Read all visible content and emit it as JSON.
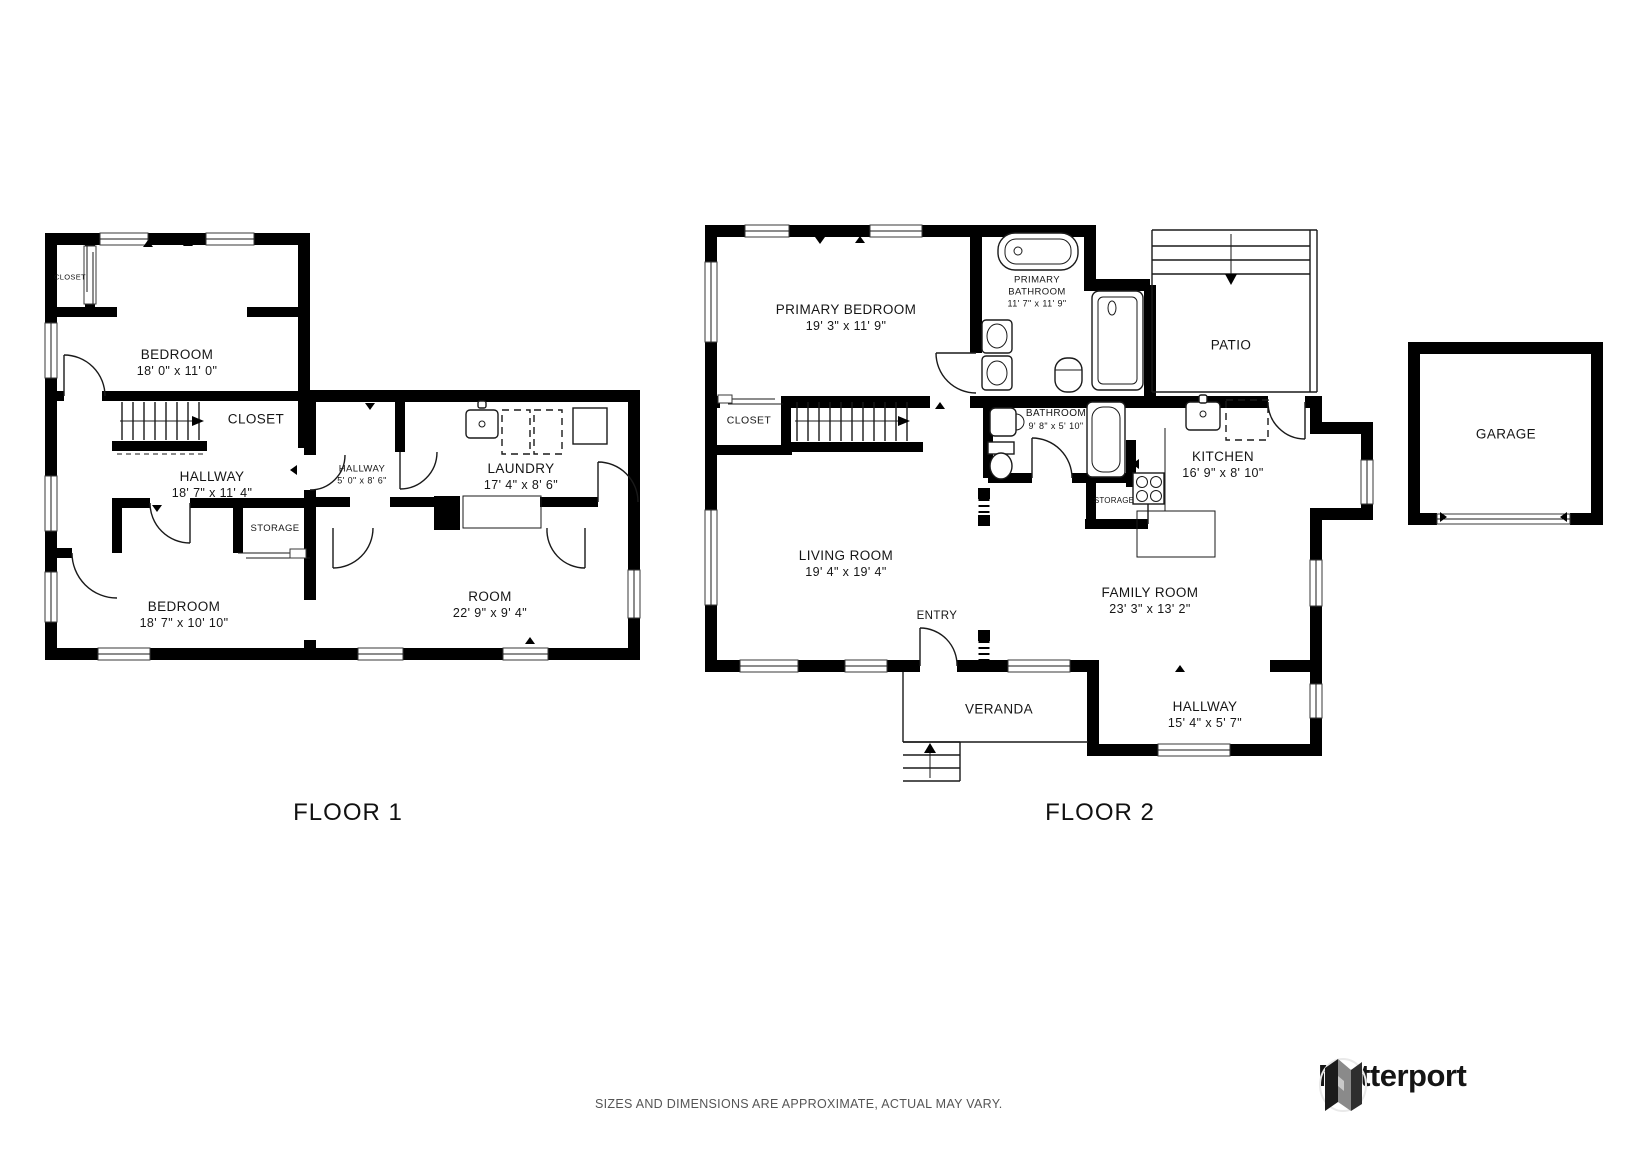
{
  "floor1": {
    "title": "FLOOR 1",
    "rooms": {
      "closet_a": {
        "name": "CLOSET",
        "dims": ""
      },
      "bedroom_a": {
        "name": "BEDROOM",
        "dims": "18' 0\" x 11' 0\""
      },
      "closet_b": {
        "name": "CLOSET",
        "dims": ""
      },
      "hallway_a": {
        "name": "HALLWAY",
        "dims": "18' 7\" x 11' 4\""
      },
      "hallway_b": {
        "name": "HALLWAY",
        "dims": "5' 0\" x 8' 6\""
      },
      "laundry": {
        "name": "LAUNDRY",
        "dims": "17' 4\" x 8' 6\""
      },
      "storage": {
        "name": "STORAGE",
        "dims": ""
      },
      "bedroom_b": {
        "name": "BEDROOM",
        "dims": "18' 7\" x 10' 10\""
      },
      "room": {
        "name": "ROOM",
        "dims": "22' 9\" x 9' 4\""
      }
    }
  },
  "floor2": {
    "title": "FLOOR 2",
    "rooms": {
      "primary_bedroom": {
        "name": "PRIMARY BEDROOM",
        "dims": "19' 3\" x 11' 9\""
      },
      "primary_bathroom": {
        "name": "PRIMARY BATHROOM",
        "dims": "11' 7\" x 11' 9\""
      },
      "patio": {
        "name": "PATIO",
        "dims": ""
      },
      "closet": {
        "name": "CLOSET",
        "dims": ""
      },
      "bathroom": {
        "name": "BATHROOM",
        "dims": "9' 8\" x 5' 10\""
      },
      "kitchen": {
        "name": "KITCHEN",
        "dims": "16' 9\" x 8' 10\""
      },
      "living_room": {
        "name": "LIVING ROOM",
        "dims": "19' 4\" x 19' 4\""
      },
      "storage": {
        "name": "STORAGE",
        "dims": ""
      },
      "family_room": {
        "name": "FAMILY ROOM",
        "dims": "23' 3\" x 13' 2\""
      },
      "entry": {
        "name": "ENTRY",
        "dims": ""
      },
      "veranda": {
        "name": "VERANDA",
        "dims": ""
      },
      "hallway": {
        "name": "HALLWAY",
        "dims": "15' 4\" x 5' 7\""
      }
    }
  },
  "garage": {
    "name": "GARAGE"
  },
  "footer": {
    "disclaimer": "SIZES AND DIMENSIONS ARE APPROXIMATE, ACTUAL MAY VARY.",
    "brand": "Matterport"
  },
  "colors": {
    "wall": "#000000",
    "text": "#161616",
    "muted": "#555555"
  }
}
